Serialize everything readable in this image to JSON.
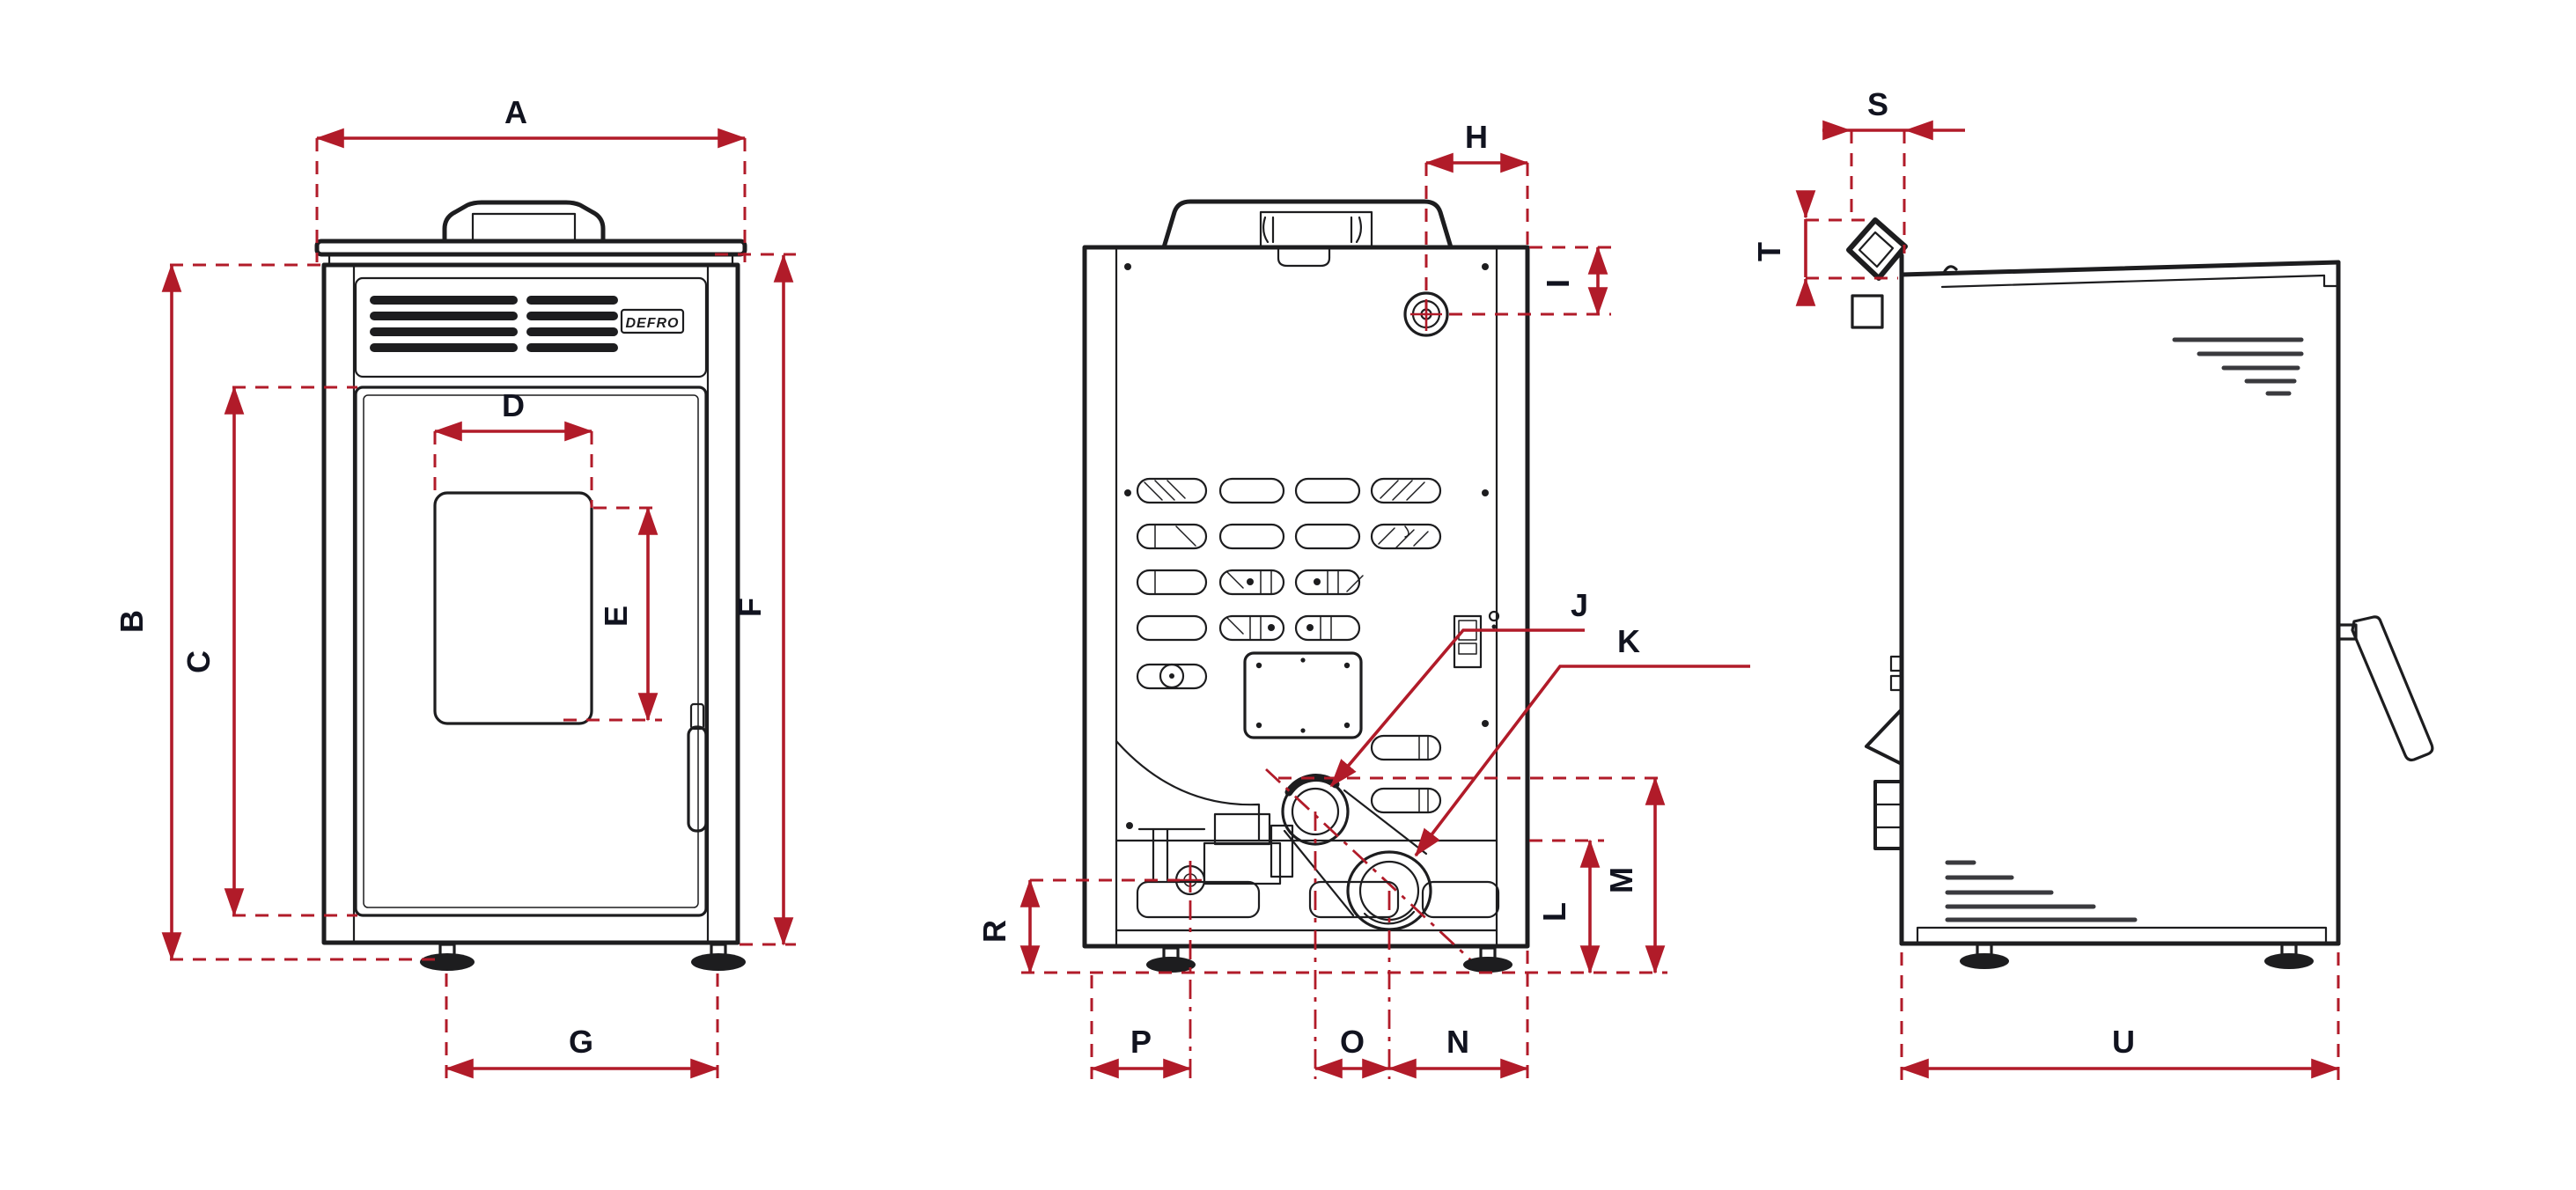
{
  "diagram": {
    "type": "technical-drawing",
    "subject": "pellet stove dimensional drawing, three orthographic views",
    "brand_label": "DEFRO",
    "colors": {
      "dimension_red": "#b11b29",
      "outline": "#1d1d1f",
      "label_text": "#11131f",
      "background": "#ffffff"
    },
    "views": [
      {
        "id": "front-view",
        "dimension_labels": [
          "A",
          "B",
          "C",
          "D",
          "E",
          "F",
          "G"
        ]
      },
      {
        "id": "rear-view",
        "dimension_labels": [
          "H",
          "I",
          "J",
          "K",
          "L",
          "M",
          "N",
          "O",
          "P",
          "R"
        ]
      },
      {
        "id": "side-view",
        "dimension_labels": [
          "S",
          "T",
          "U"
        ]
      }
    ],
    "labels": {
      "A": "A",
      "B": "B",
      "C": "C",
      "D": "D",
      "E": "E",
      "F": "F",
      "G": "G",
      "H": "H",
      "I": "I",
      "J": "J",
      "K": "K",
      "L": "L",
      "M": "M",
      "N": "N",
      "O": "O",
      "P": "P",
      "R": "R",
      "S": "S",
      "T": "T",
      "U": "U"
    }
  }
}
